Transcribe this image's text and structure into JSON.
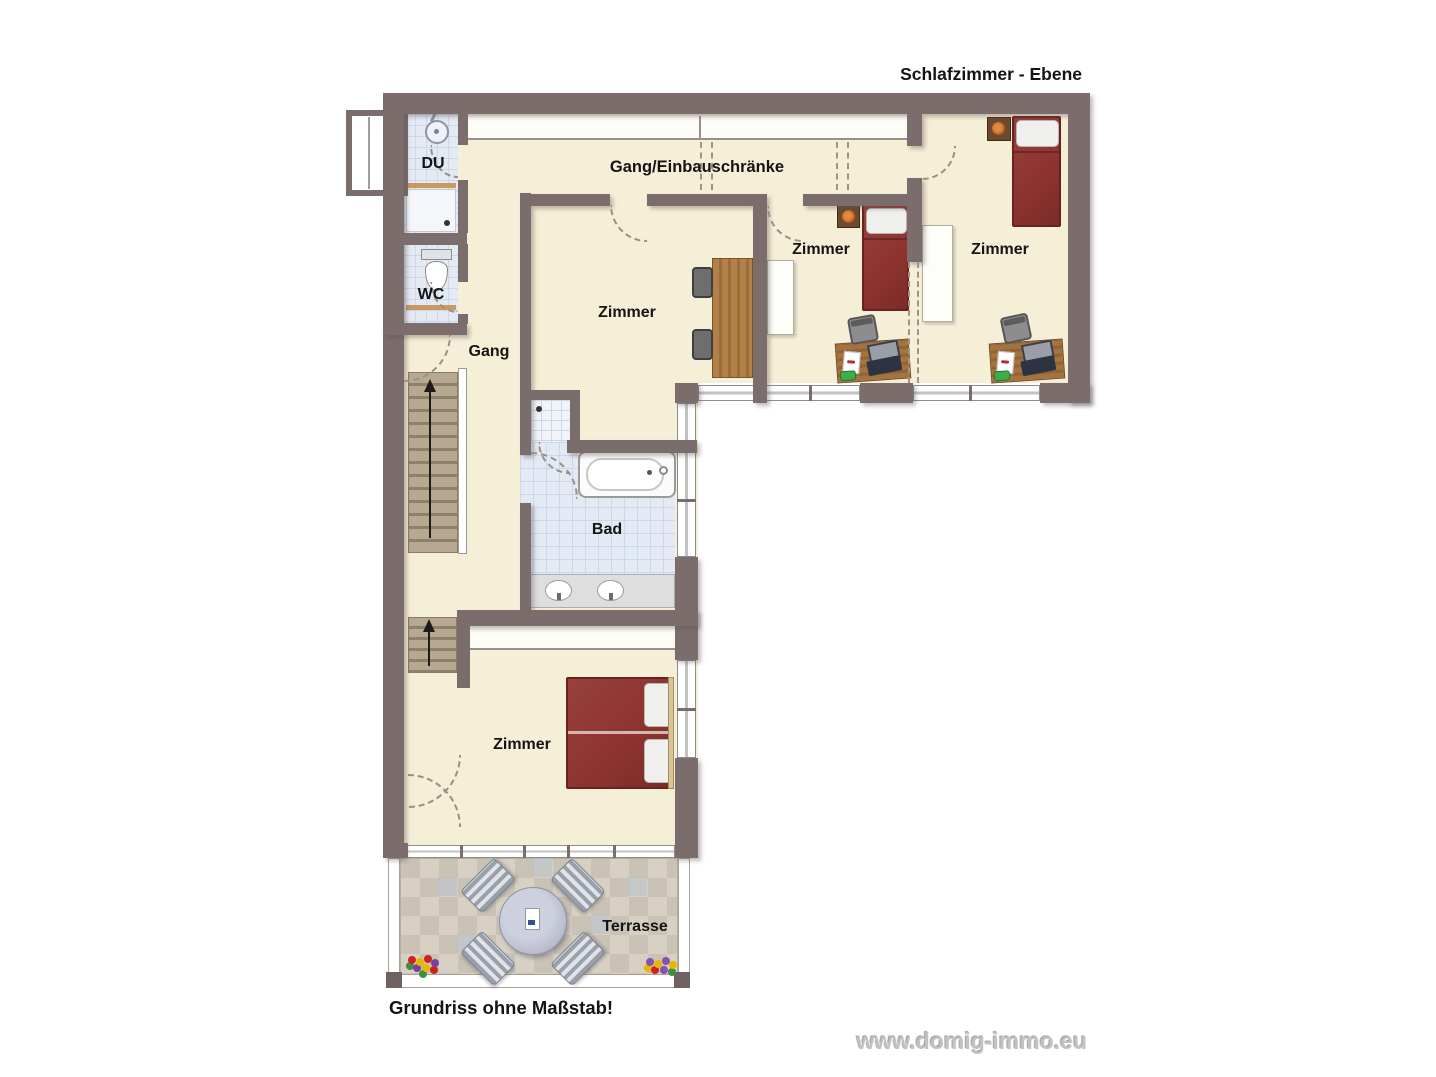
{
  "title": "Schlafzimmer - Ebene",
  "footer_note": "Grundriss ohne Maßstab!",
  "watermark": "www.domig-immo.eu",
  "rooms": {
    "du": {
      "label": "DU"
    },
    "wc": {
      "label": "WC"
    },
    "gang": {
      "label": "Gang"
    },
    "corridor": {
      "label": "Gang/Einbauschränke"
    },
    "zimmer_center": {
      "label": "Zimmer"
    },
    "zimmer_middle": {
      "label": "Zimmer"
    },
    "zimmer_right": {
      "label": "Zimmer"
    },
    "bad": {
      "label": "Bad"
    },
    "zimmer_bottom": {
      "label": "Zimmer"
    },
    "terrasse": {
      "label": "Terrasse"
    }
  },
  "icons": {
    "shower": "shower-icon",
    "toilet": "toilet-icon",
    "bathtub": "bathtub-icon",
    "sink": "sink-icon",
    "stairs_up": "up-arrow-icon",
    "flowers": "flowers-icon"
  },
  "colors": {
    "wall": "#7c6d6d",
    "floor_cream": "#f6efd8",
    "bath_tile": "#e4eaf4",
    "terrace_tile_light": "#d8d1c3",
    "terrace_tile_dark": "#cac3b5",
    "bed_red": "#8e3430",
    "desk_wood": "#a5743e",
    "stair_tread": "#b7a991",
    "label_text": "#141414",
    "watermark_gray": "#c2c2c2"
  }
}
